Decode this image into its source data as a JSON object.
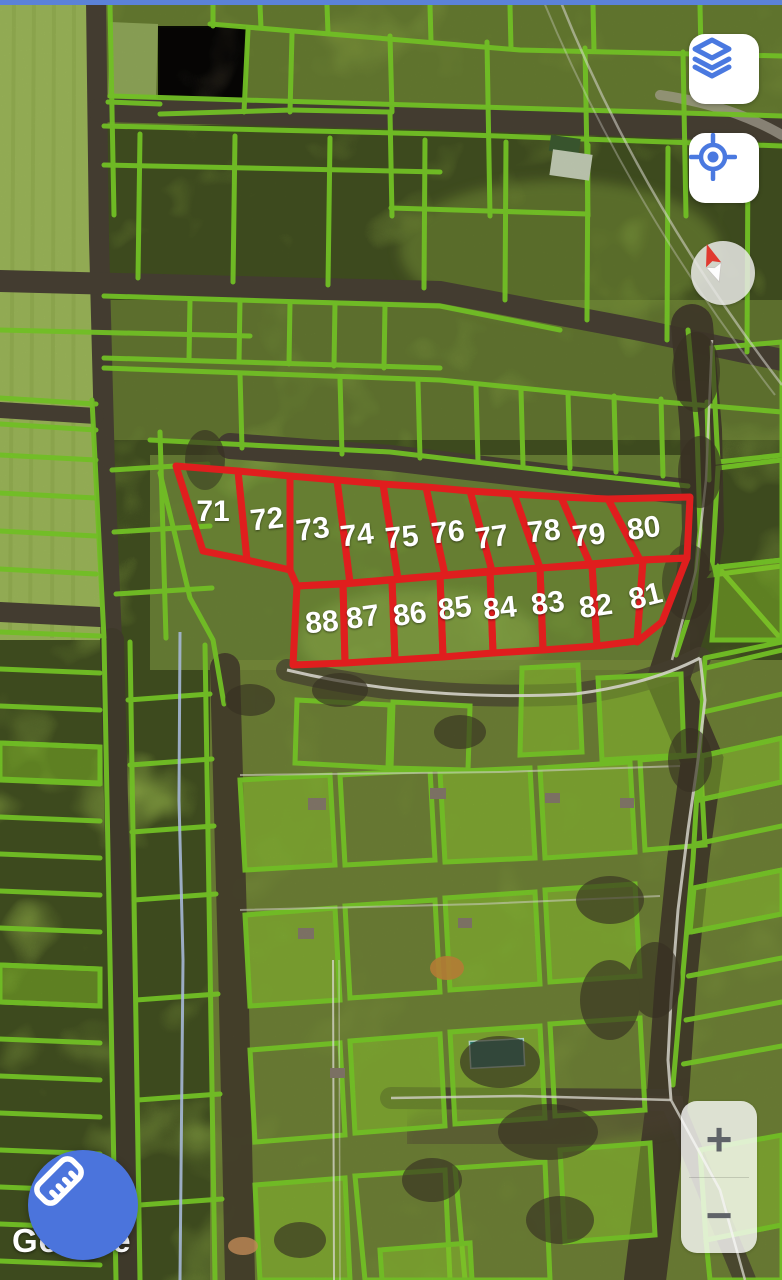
{
  "map": {
    "provider_attribution": "Google",
    "type": "satellite-cadastral",
    "colors": {
      "parcel_outline_red": "#e01e1e",
      "parcel_label": "#ffffff",
      "cadastral_line_lime": "#7fd62a",
      "control_icon_blue": "#4a79e0",
      "measure_fab_bg": "#4b74dc",
      "zoom_label_grey": "#5f6368",
      "compass_needle_red": "#e03a2f",
      "top_edge_line_blue": "#5b82d8"
    },
    "surveyed_parcels": [
      {
        "label": "71",
        "points": "176,466 238,471 247,560 203,551",
        "lx": 213,
        "ly": 513,
        "angle": 0
      },
      {
        "label": "72",
        "points": "238,471 290,476 290,570 247,560",
        "lx": 267,
        "ly": 521,
        "angle": -6
      },
      {
        "label": "73",
        "points": "290,476 337,480 350,583 297,586 290,570",
        "lx": 313,
        "ly": 531,
        "angle": -8
      },
      {
        "label": "74",
        "points": "337,480 383,484 398,579 350,583",
        "lx": 357,
        "ly": 537,
        "angle": -6
      },
      {
        "label": "75",
        "points": "383,484 426,487 445,575 398,579",
        "lx": 402,
        "ly": 539,
        "angle": -6
      },
      {
        "label": "76",
        "points": "426,487 470,491 492,571 445,575",
        "lx": 448,
        "ly": 534,
        "angle": -6
      },
      {
        "label": "77",
        "points": "470,491 514,494 540,568 492,571",
        "lx": 492,
        "ly": 539,
        "angle": -8
      },
      {
        "label": "78",
        "points": "514,494 561,497 590,564 540,568",
        "lx": 544,
        "ly": 533,
        "angle": -6
      },
      {
        "label": "79",
        "points": "561,497 608,499 640,560 590,564",
        "lx": 589,
        "ly": 537,
        "angle": -6
      },
      {
        "label": "80",
        "points": "608,499 690,497 687,558 640,560",
        "lx": 644,
        "ly": 530,
        "angle": -8
      },
      {
        "label": "81",
        "points": "643,560 687,558 662,622 637,642",
        "lx": 646,
        "ly": 598,
        "angle": -14
      },
      {
        "label": "82",
        "points": "592,565 643,560 637,641 597,646",
        "lx": 596,
        "ly": 608,
        "angle": -8
      },
      {
        "label": "83",
        "points": "540,568 592,565 597,646 543,650",
        "lx": 548,
        "ly": 605,
        "angle": -8
      },
      {
        "label": "84",
        "points": "490,572 540,568 543,650 493,653",
        "lx": 500,
        "ly": 610,
        "angle": -6
      },
      {
        "label": "85",
        "points": "440,576 490,572 493,653 443,657",
        "lx": 455,
        "ly": 610,
        "angle": -8
      },
      {
        "label": "86",
        "points": "392,580 440,576 443,657 395,660",
        "lx": 410,
        "ly": 616,
        "angle": -8
      },
      {
        "label": "87",
        "points": "343,584 392,580 395,660 345,663",
        "lx": 363,
        "ly": 619,
        "angle": -8
      },
      {
        "label": "88",
        "points": "297,586 343,584 345,663 293,665",
        "lx": 322,
        "ly": 624,
        "angle": -5
      }
    ],
    "controls": {
      "layers_button": {
        "icon": "layers-icon"
      },
      "my_location_button": {
        "icon": "my-location-icon"
      },
      "compass": {
        "icon": "compass-needle-icon"
      },
      "zoom_in_label": "+",
      "zoom_out_label": "−",
      "measure_button": {
        "icon": "ruler-icon"
      }
    }
  }
}
